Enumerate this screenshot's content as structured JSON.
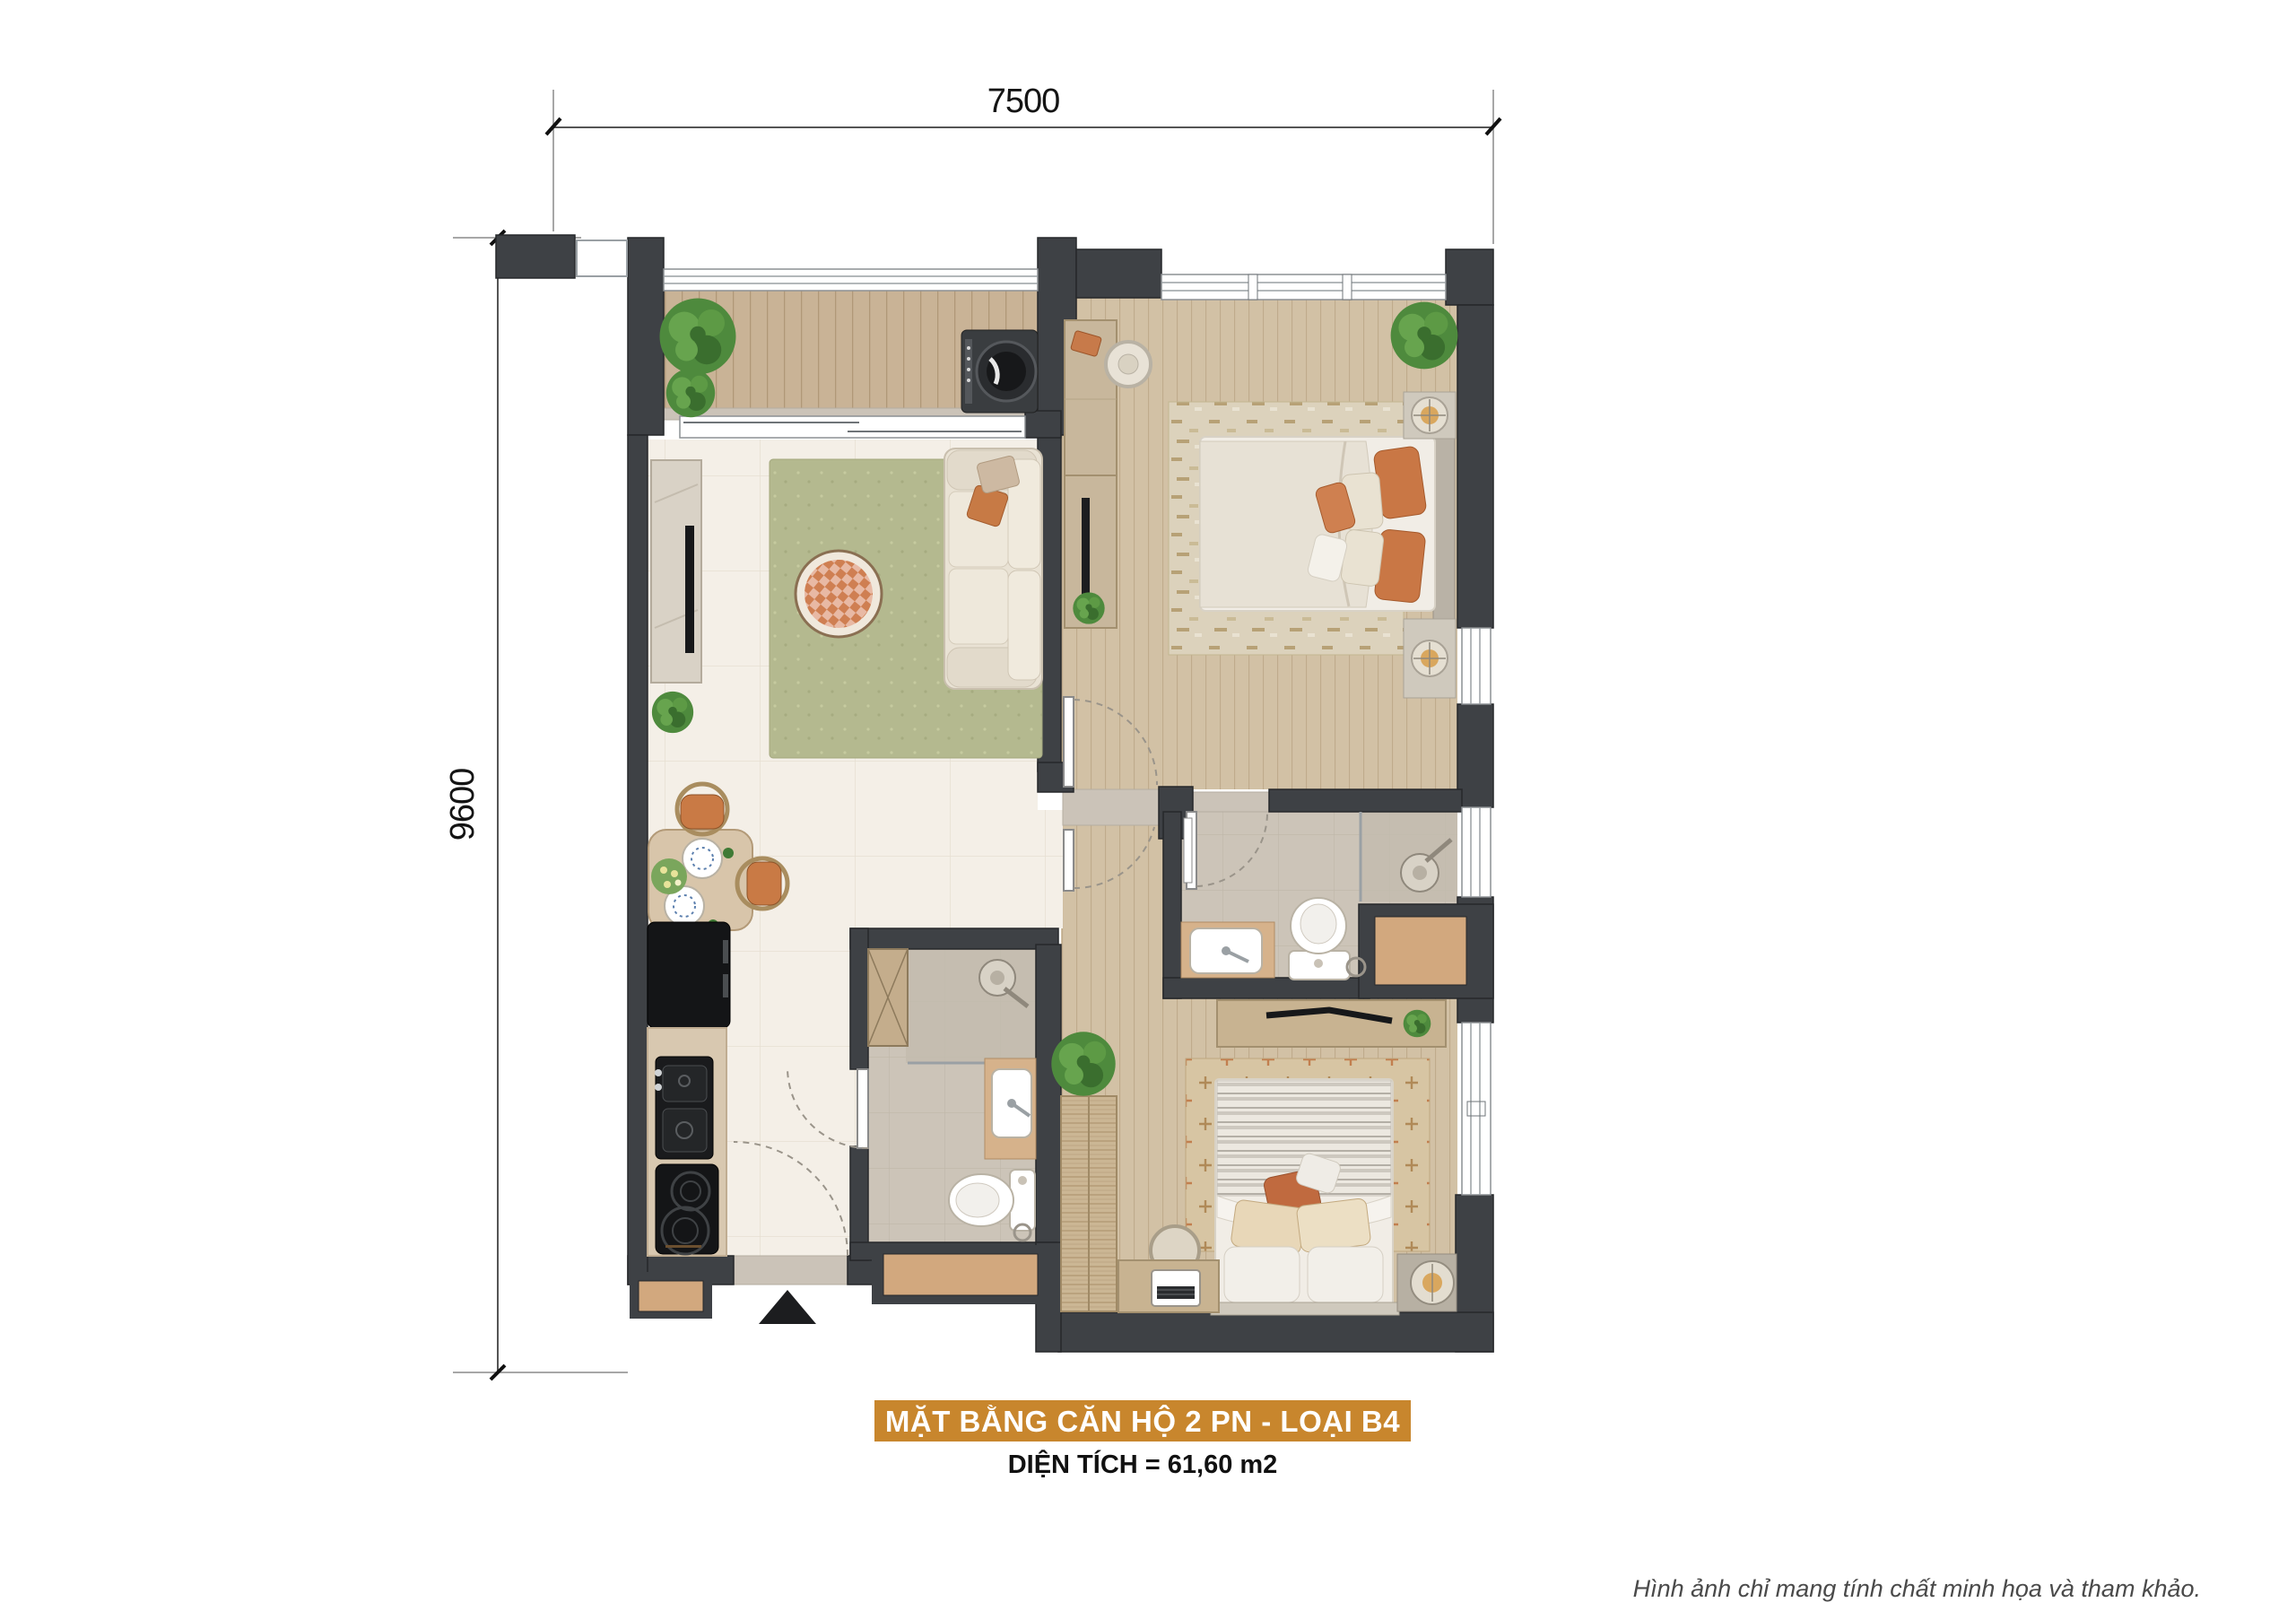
{
  "dimensions": {
    "top": "7500",
    "left": "9600"
  },
  "title_banner": {
    "text": "MẶT BẰNG CĂN HỘ 2 PN - LOẠI B4",
    "bg_color": "#c8862d",
    "text_color": "#ffffff"
  },
  "area_line": {
    "text": "DIỆN TÍCH = 61,60 m2"
  },
  "disclaimer": {
    "text": "Hình ảnh chỉ mang tính chất minh họa và tham khảo."
  },
  "plan_colors": {
    "wall": "#3e4145",
    "balcony_deck": "#c9b396",
    "bedroom_wood": "#d2c1a5",
    "living_tile": "#f4efe7",
    "bath_tile": "#ccc4b8",
    "rug_green": "#b4b98f",
    "rug_beige": "#dcd2bc",
    "counter_tan": "#d2a87e",
    "accent_orange": "#c97a45",
    "plant_green": "#4e8a3d",
    "appliance_black": "#17181a"
  }
}
